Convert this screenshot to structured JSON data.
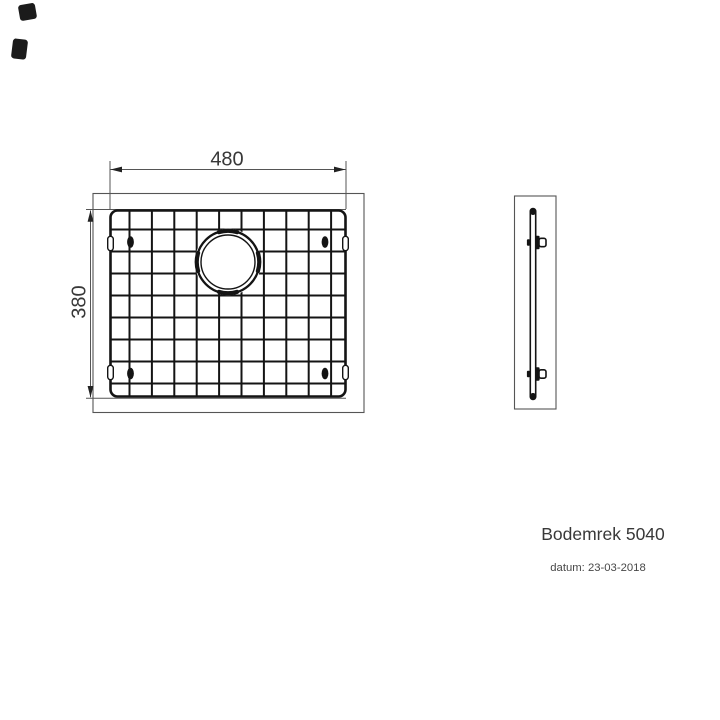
{
  "drawing": {
    "title": "Bodemrek 5040",
    "date": "datum: 23-03-2018",
    "front_view": {
      "width_dim": "480",
      "height_dim": "380"
    },
    "grid_spec": {
      "vertical_wires": 10,
      "horizontal_wires": 8
    },
    "colors": {
      "wire": "#141414",
      "thin_line": "#555555",
      "text": "#383838"
    }
  }
}
